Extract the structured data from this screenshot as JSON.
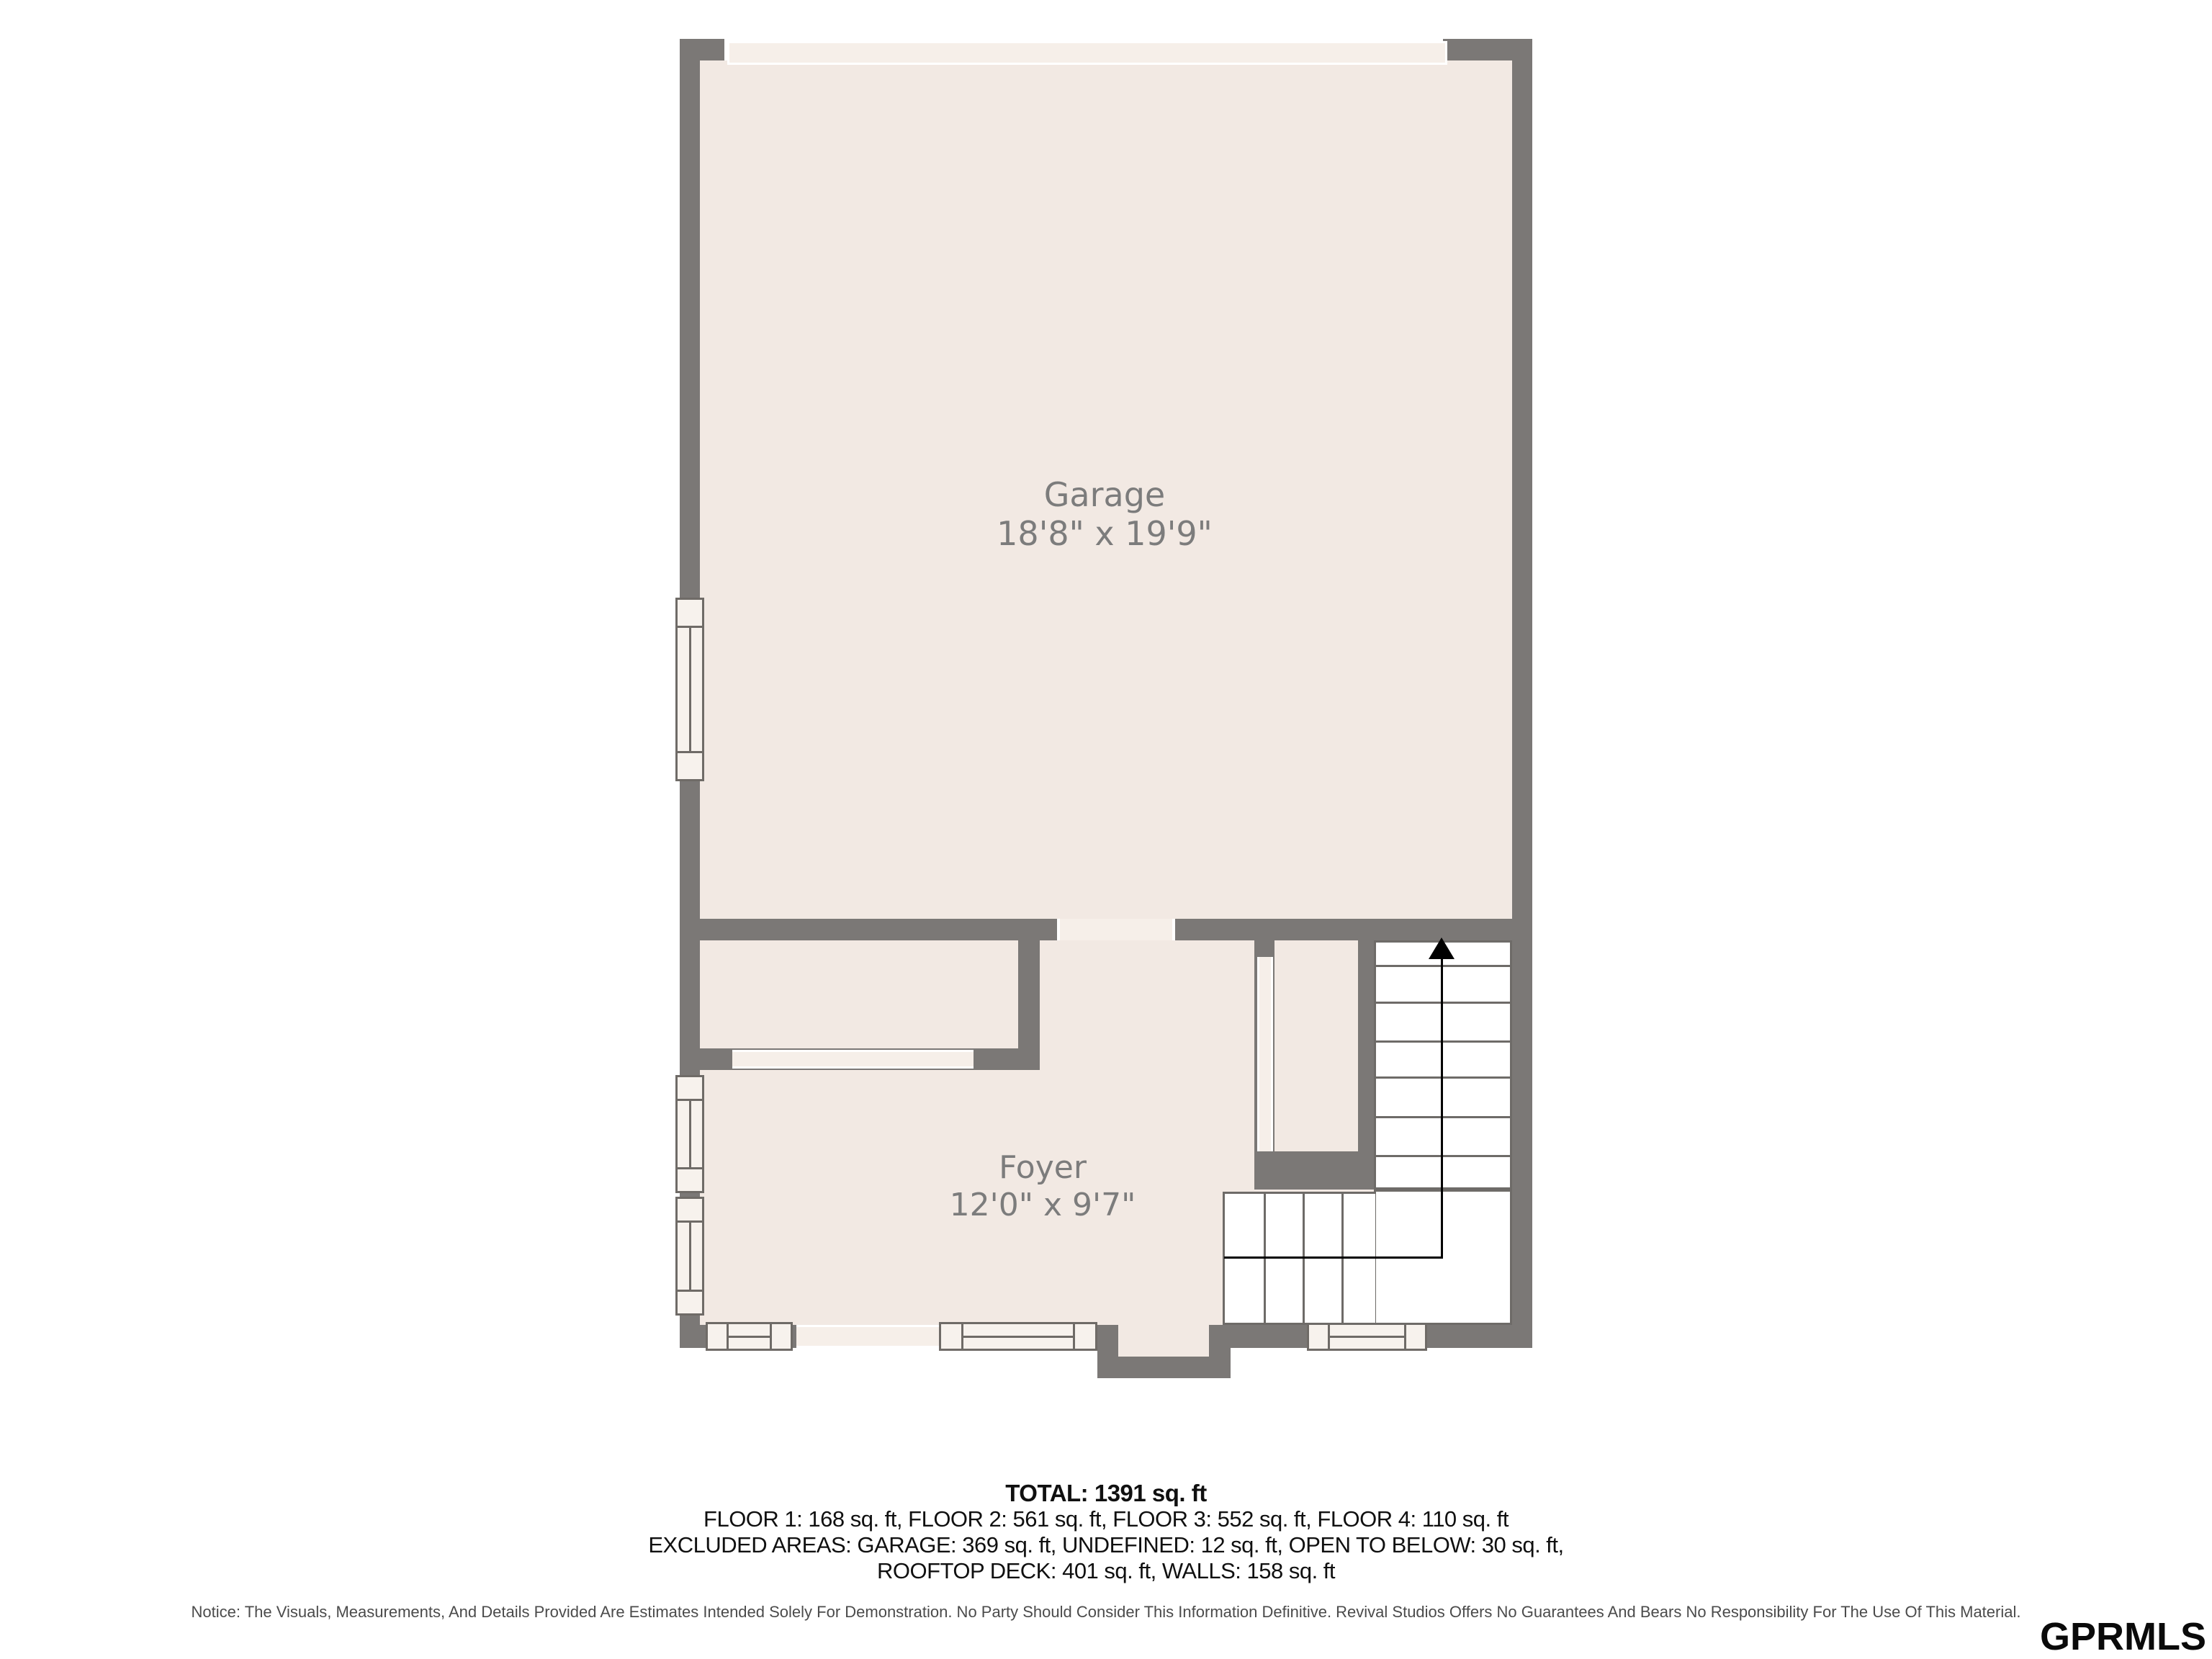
{
  "plan": {
    "rooms": [
      {
        "name": "Garage",
        "dims": "18'8\" x 19'9\""
      },
      {
        "name": "Foyer",
        "dims": "12'0\" x 9'7\""
      }
    ],
    "stairs": {
      "direction": "up"
    }
  },
  "summary": {
    "total": "TOTAL: 1391 sq. ft",
    "floors": "FLOOR 1: 168 sq. ft, FLOOR 2: 561 sq. ft, FLOOR 3: 552 sq. ft, FLOOR 4: 110 sq. ft",
    "excluded1": "EXCLUDED AREAS: GARAGE: 369 sq. ft, UNDEFINED: 12 sq. ft, OPEN TO BELOW: 30 sq. ft,",
    "excluded2": "ROOFTOP DECK: 401 sq. ft, WALLS: 158 sq. ft"
  },
  "notice": "Notice: The Visuals, Measurements, And Details Provided Are Estimates Intended Solely For Demonstration. No Party Should Consider This Information Definitive. Revival Studios Offers No Guarantees And Bears No Responsibility For The Use Of This Material.",
  "watermark": "GPRMLS",
  "colors": {
    "wall": "#7b7876",
    "room_fill": "#f2e9e3",
    "opening_fill": "#f6efe9",
    "window_fill": "#f7f2ed",
    "stair_outline": "#6e6b68",
    "label_text": "#7c7c7c",
    "direction_line": "#000000"
  }
}
